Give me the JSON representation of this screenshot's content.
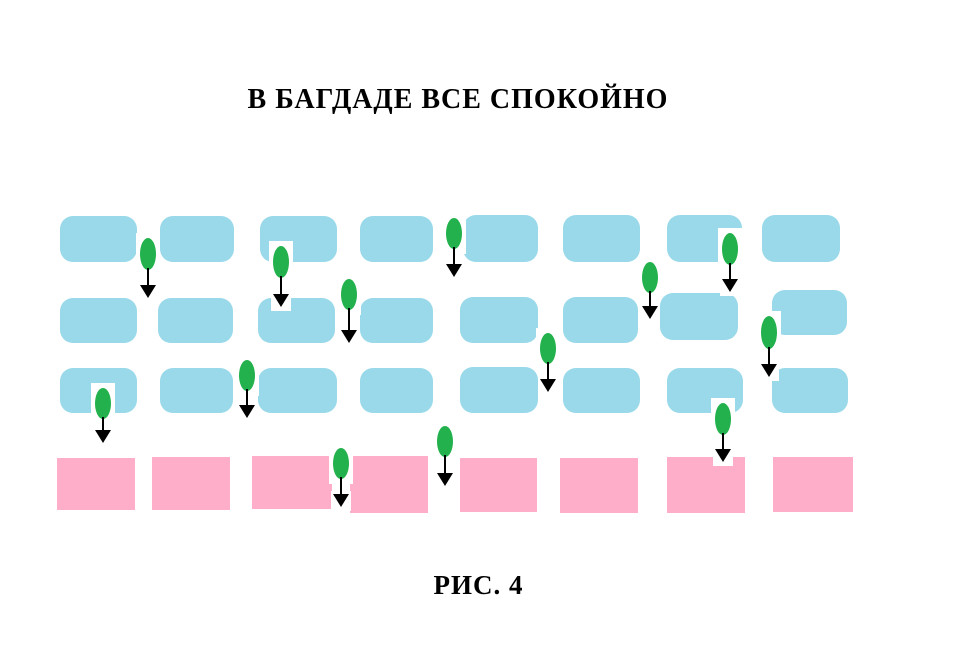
{
  "title": "В БАГДАДЕ ВСЕ СПОКОЙНО",
  "caption": "РИС. 4",
  "colors": {
    "background": "#ffffff",
    "block_blue": "#99d9ea",
    "block_pink": "#ffaec9",
    "seed_green": "#22b14c",
    "arrow_black": "#000000",
    "text": "#000000"
  },
  "diagram": {
    "description": "Three rows of light-blue rounded blocks above one row of pink blocks; green seed markers with downward arrows fall through gaps and notches between the blocks.",
    "block_rows": [
      {
        "name": "brick-row-1",
        "type": "blue",
        "blocks": [
          {
            "x": 60,
            "y": 216,
            "w": 77,
            "h": 46
          },
          {
            "x": 160,
            "y": 216,
            "w": 74,
            "h": 46
          },
          {
            "x": 260,
            "y": 216,
            "w": 77,
            "h": 46
          },
          {
            "x": 360,
            "y": 216,
            "w": 73,
            "h": 46
          },
          {
            "x": 463,
            "y": 215,
            "w": 75,
            "h": 47
          },
          {
            "x": 563,
            "y": 215,
            "w": 77,
            "h": 47
          },
          {
            "x": 667,
            "y": 215,
            "w": 75,
            "h": 47
          },
          {
            "x": 762,
            "y": 215,
            "w": 78,
            "h": 47
          }
        ]
      },
      {
        "name": "brick-row-2",
        "type": "blue",
        "blocks": [
          {
            "x": 60,
            "y": 298,
            "w": 77,
            "h": 45
          },
          {
            "x": 158,
            "y": 298,
            "w": 75,
            "h": 45
          },
          {
            "x": 258,
            "y": 298,
            "w": 77,
            "h": 45
          },
          {
            "x": 360,
            "y": 298,
            "w": 73,
            "h": 45
          },
          {
            "x": 460,
            "y": 297,
            "w": 78,
            "h": 46
          },
          {
            "x": 563,
            "y": 297,
            "w": 75,
            "h": 46
          },
          {
            "x": 660,
            "y": 293,
            "w": 78,
            "h": 47
          },
          {
            "x": 772,
            "y": 290,
            "w": 75,
            "h": 45
          }
        ]
      },
      {
        "name": "brick-row-3",
        "type": "blue",
        "blocks": [
          {
            "x": 60,
            "y": 368,
            "w": 77,
            "h": 45
          },
          {
            "x": 160,
            "y": 368,
            "w": 73,
            "h": 45
          },
          {
            "x": 258,
            "y": 368,
            "w": 79,
            "h": 45
          },
          {
            "x": 360,
            "y": 368,
            "w": 73,
            "h": 45
          },
          {
            "x": 460,
            "y": 367,
            "w": 78,
            "h": 46
          },
          {
            "x": 563,
            "y": 368,
            "w": 77,
            "h": 45
          },
          {
            "x": 667,
            "y": 368,
            "w": 76,
            "h": 45
          },
          {
            "x": 772,
            "y": 368,
            "w": 76,
            "h": 45
          }
        ]
      },
      {
        "name": "ground-row",
        "type": "pink",
        "blocks": [
          {
            "x": 57,
            "y": 458,
            "w": 78,
            "h": 52
          },
          {
            "x": 152,
            "y": 457,
            "w": 78,
            "h": 53
          },
          {
            "x": 252,
            "y": 456,
            "w": 80,
            "h": 53
          },
          {
            "x": 350,
            "y": 456,
            "w": 78,
            "h": 57
          },
          {
            "x": 460,
            "y": 458,
            "w": 77,
            "h": 54
          },
          {
            "x": 560,
            "y": 458,
            "w": 78,
            "h": 55
          },
          {
            "x": 667,
            "y": 457,
            "w": 78,
            "h": 56
          },
          {
            "x": 773,
            "y": 457,
            "w": 80,
            "h": 55
          }
        ]
      }
    ],
    "seeds": [
      {
        "cx": 148,
        "y": 238,
        "h": 32,
        "tip": 298
      },
      {
        "cx": 281,
        "y": 246,
        "h": 32,
        "tip": 307
      },
      {
        "cx": 454,
        "y": 218,
        "h": 31,
        "tip": 277
      },
      {
        "cx": 730,
        "y": 233,
        "h": 32,
        "tip": 292
      },
      {
        "cx": 650,
        "y": 262,
        "h": 31,
        "tip": 319
      },
      {
        "cx": 349,
        "y": 279,
        "h": 31,
        "tip": 343
      },
      {
        "cx": 548,
        "y": 333,
        "h": 31,
        "tip": 392
      },
      {
        "cx": 769,
        "y": 316,
        "h": 33,
        "tip": 377
      },
      {
        "cx": 103,
        "y": 388,
        "h": 31,
        "tip": 443
      },
      {
        "cx": 247,
        "y": 360,
        "h": 31,
        "tip": 418
      },
      {
        "cx": 723,
        "y": 403,
        "h": 32,
        "tip": 462
      },
      {
        "cx": 341,
        "y": 448,
        "h": 31,
        "tip": 507
      },
      {
        "cx": 445,
        "y": 426,
        "h": 31,
        "tip": 486
      }
    ]
  }
}
